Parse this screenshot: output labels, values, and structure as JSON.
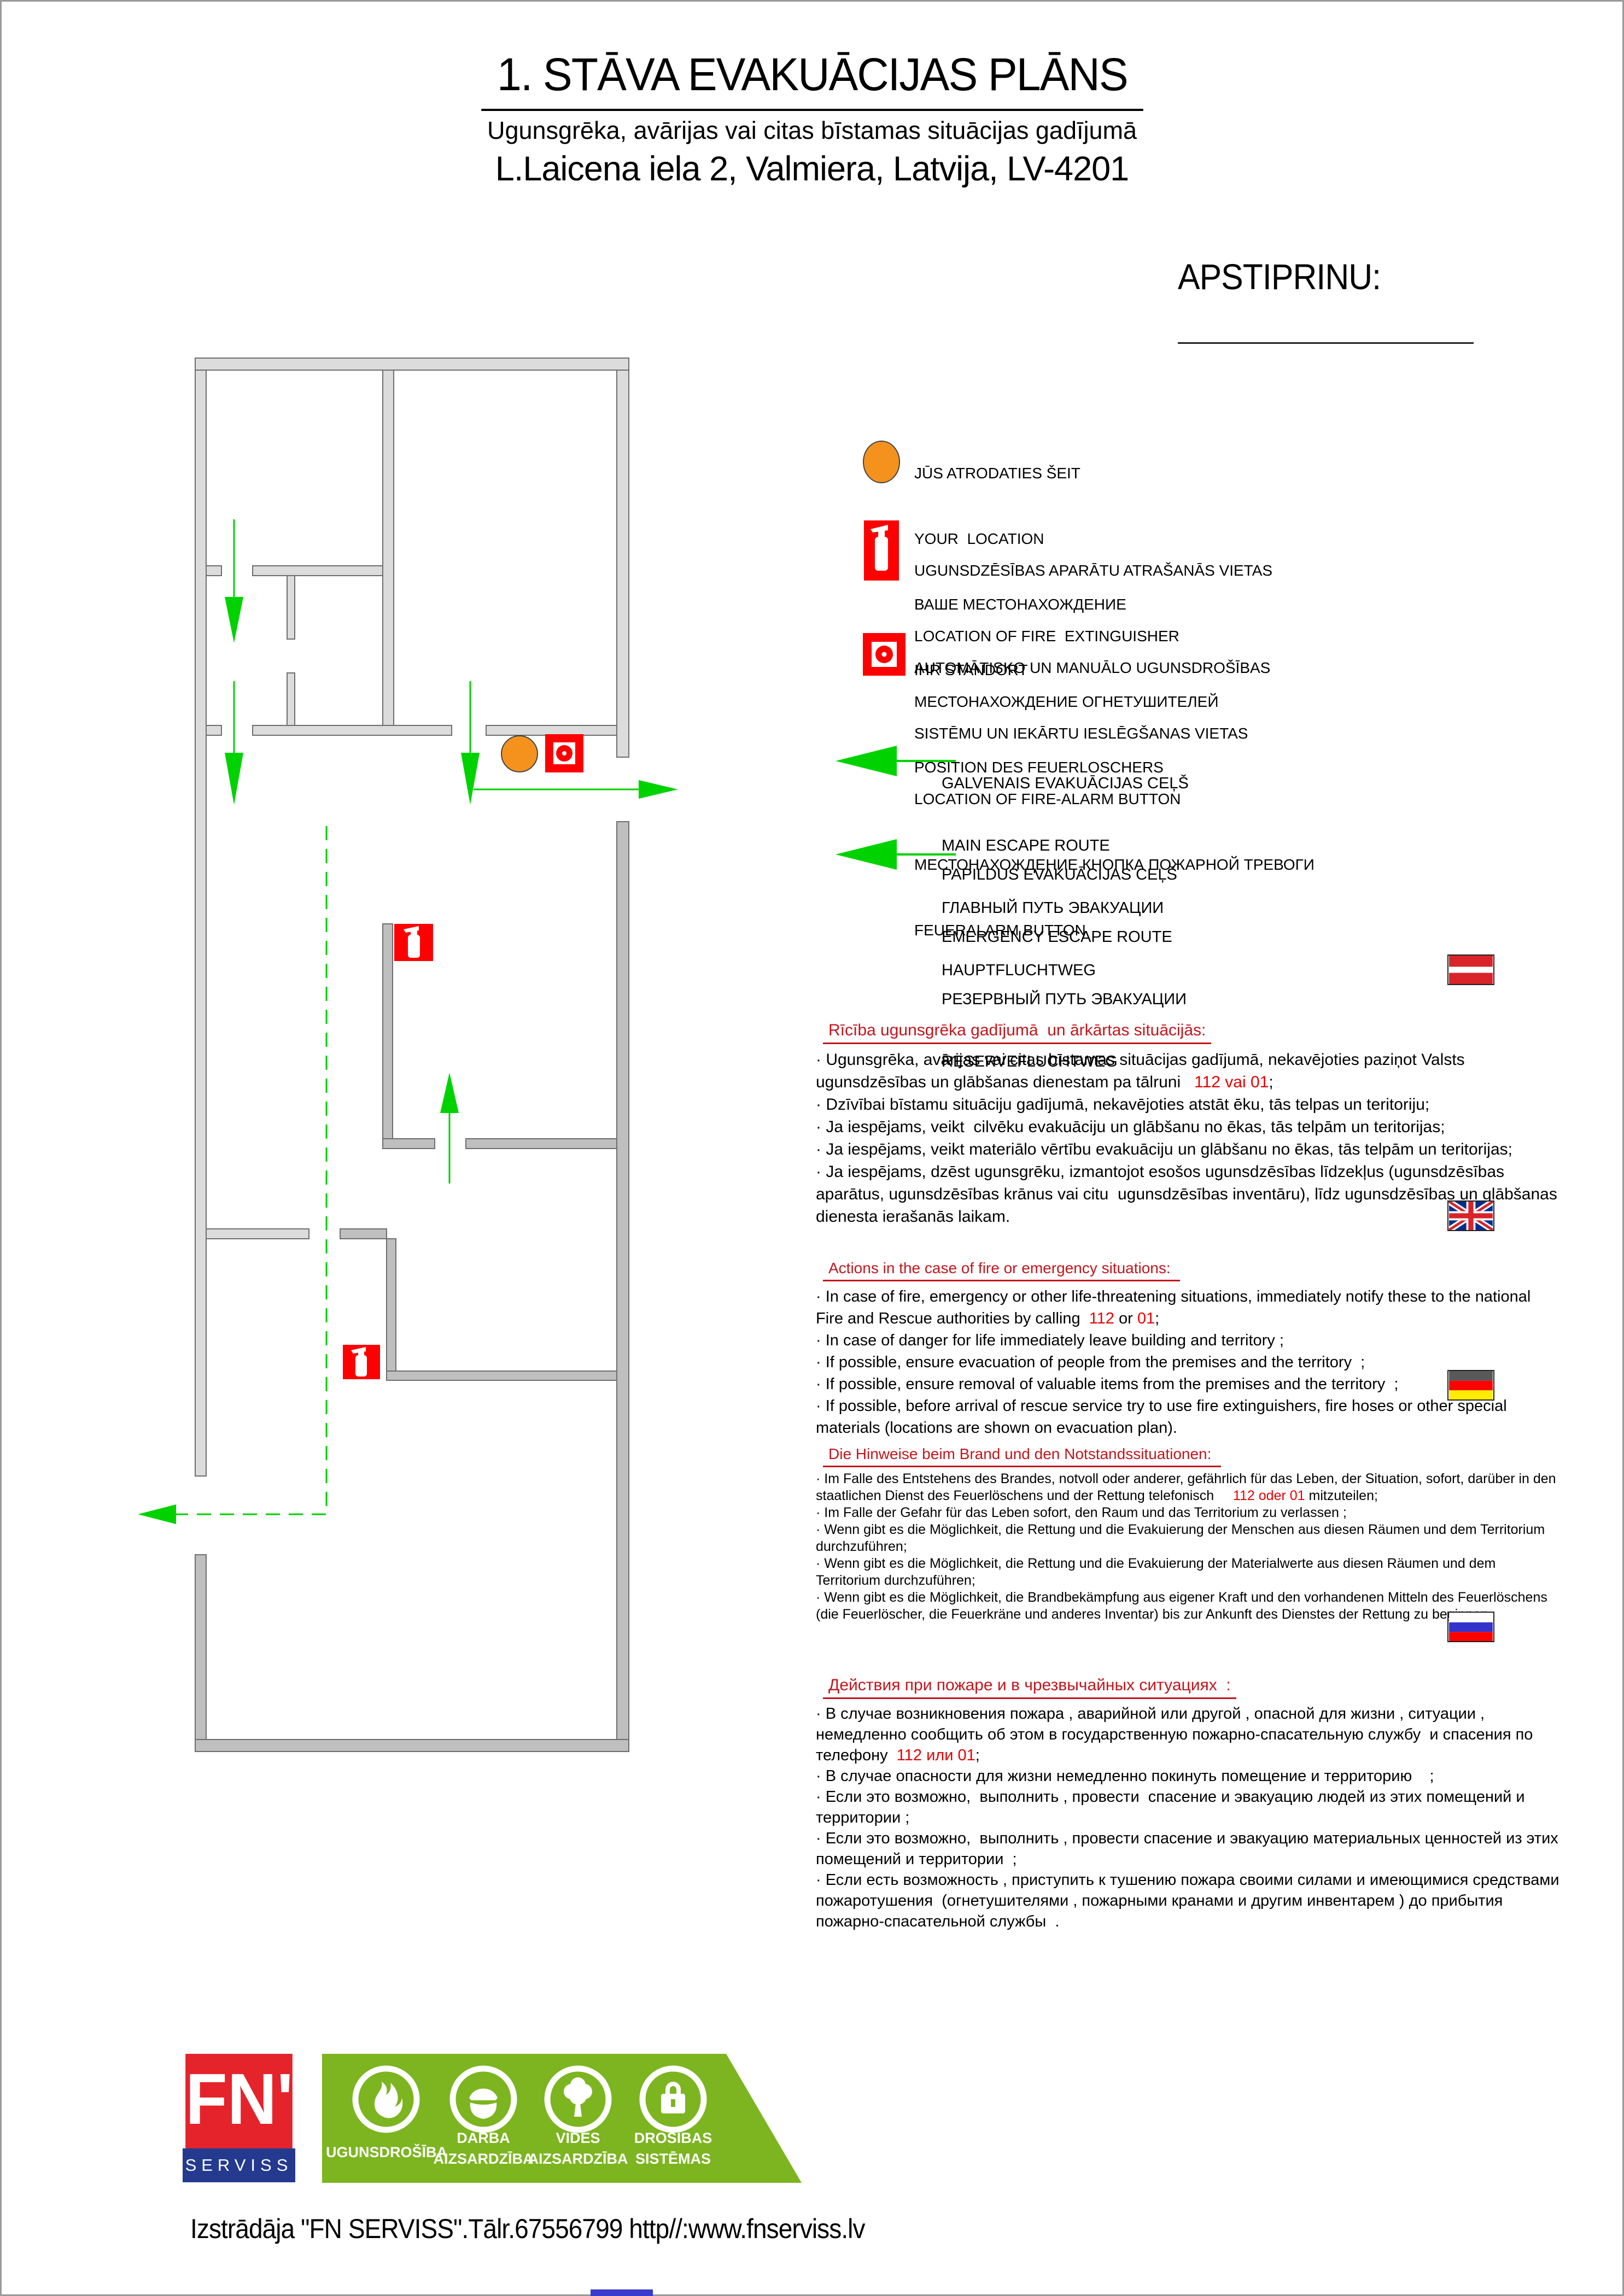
{
  "header": {
    "title": "1. STĀVA EVAKUĀCIJAS PLĀNS",
    "subtitle": "Ugunsgrēka, avārijas vai citas bīstamas situācijas gadījumā",
    "address": "L.Laicena iela 2, Valmiera, Latvija, LV-4201",
    "approve_label": "APSTIPRINU:"
  },
  "colors": {
    "route_green": "#00d200",
    "marker_orange": "#f5921e",
    "symbol_red": "#ff0000",
    "heading_red": "#c3151c",
    "phone_red": "#e60000",
    "wall_light": "#dcdcdc",
    "wall_dark": "#bfbfbf",
    "logo_red": "#e5232b",
    "logo_blue": "#243a8f",
    "logo_green": "#7cb51f"
  },
  "legend": {
    "items": [
      {
        "icon": "your-location-icon",
        "lines": [
          "JŪS ATRODATIES ŠEIT",
          "YOUR  LOCATION",
          "ВАШЕ МЕСТОНАХОЖДЕНИЕ",
          "IHR STANDORT"
        ]
      },
      {
        "icon": "fire-extinguisher-icon",
        "lines": [
          "UGUNSDZĒSĪBAS APARĀTU ATRAŠANĀS VIETAS",
          "LOCATION OF FIRE  EXTINGUISHER",
          "МЕСТОНАХОЖДЕНИЕ ОГНЕТУШИТЕЛЕЙ",
          "POSITION DES FEUERLOSCHERS"
        ]
      },
      {
        "icon": "fire-alarm-button-icon",
        "lines": [
          "AUTOMĀTISKO UN MANUĀLO UGUNSDROŠĪBAS",
          "SISTĒMU UN IEKĀRTU IESLĒGŠANAS VIETAS",
          "LOCATION OF FIRE-ALARM BUTTON",
          "МЕСТОНАХОЖДЕНИЕ КНОПКА ПОЖАРНОЙ ТРЕВОГИ",
          "FEUERALARM BUTTON"
        ]
      },
      {
        "icon": "main-escape-route-arrow-icon",
        "lines": [
          "GALVENAIS EVAKUĀCIJAS CEĻŠ",
          "MAIN ESCAPE ROUTE",
          "ГЛАВНЫЙ ПУТЬ ЭВАКУАЦИИ",
          "HAUPTFLUCHTWEG"
        ]
      },
      {
        "icon": "emergency-escape-route-arrow-icon",
        "lines": [
          "PAPILDUS EVAKUĀCIJAS CEĻŠ",
          "EMERGENCY ESCAPE ROUTE",
          "РЕЗЕРВНЫЙ ПУТЬ ЭВАКУАЦИИ",
          "RESERVEFLUCHTWEG"
        ]
      }
    ]
  },
  "sections": [
    {
      "lang": "lv",
      "flag": "latvia-flag",
      "heading": "Rīcība ugunsgrēka gadījumā  un ārkārtas situācijās:",
      "paragraphs": [
        [
          {
            "t": "· Ugunsgrēka, avārijas vai citas bīstamas situācijas gadījumā, nekavējoties paziņot Valsts ugunsdzēsības un glābšanas dienestam pa tālruni   "
          },
          {
            "t": "112 vai 01",
            "red": true
          },
          {
            "t": ";"
          }
        ],
        [
          {
            "t": "· Dzīvībai bīstamu situāciju gadījumā, nekavējoties atstāt ēku, tās telpas un teritoriju;"
          }
        ],
        [
          {
            "t": "· Ja iespējams, veikt  cilvēku evakuāciju un glābšanu no ēkas, tās telpām un teritorijas;"
          }
        ],
        [
          {
            "t": "· Ja iespējams, veikt materiālo vērtību evakuāciju un glābšanu no ēkas, tās telpām un teritorijas;"
          }
        ],
        [
          {
            "t": "· Ja iespējams, dzēst ugunsgrēku, izmantojot esošos ugunsdzēsības līdzekļus (ugunsdzēsības aparātus, ugunsdzēsības krānus vai citu  ugunsdzēsības inventāru), līdz ugunsdzēsības un glābšanas dienesta ierašanās laikam."
          }
        ]
      ]
    },
    {
      "lang": "en",
      "flag": "united-kingdom-flag",
      "heading": "Actions in the case of fire or emergency situations: ",
      "paragraphs": [
        [
          {
            "t": "· In case of fire, emergency or other life-threatening situations, immediately notify these to the national Fire and Rescue authorities by calling  "
          },
          {
            "t": "112",
            "red": true
          },
          {
            "t": " or "
          },
          {
            "t": "01",
            "red": true
          },
          {
            "t": ";"
          }
        ],
        [
          {
            "t": "· In case of danger for life immediately leave building and territory ;"
          }
        ],
        [
          {
            "t": "· If possible, ensure evacuation of people from the premises and the territory  ;"
          }
        ],
        [
          {
            "t": "· If possible, ensure removal of valuable items from the premises and the territory  ;"
          }
        ],
        [
          {
            "t": "· If possible, before arrival of rescue service try to use fire extinguishers, fire hoses or other special materials (locations are shown on evacuation plan)."
          }
        ]
      ]
    },
    {
      "lang": "de",
      "flag": "germany-flag",
      "heading": "Die Hinweise beim Brand und den Notstandssituationen: ",
      "paragraphs": [
        [
          {
            "t": "· Im Falle des Entstehens des Brandes, notvoll oder anderer, gefährlich für das Leben, der Situation, sofort, darüber in den staatlichen Dienst des Feuerlöschens und der Rettung telefonisch     "
          },
          {
            "t": "112 oder 01",
            "red": true
          },
          {
            "t": " mitzuteilen;"
          }
        ],
        [
          {
            "t": "· Im Falle der Gefahr für das Leben sofort, den Raum und das Territorium zu verlassen ;"
          }
        ],
        [
          {
            "t": "· Wenn gibt es die Möglichkeit, die Rettung und die Evakuierung der Menschen aus diesen Räumen und dem Territorium durchzuführen;"
          }
        ],
        [
          {
            "t": "· Wenn gibt es die Möglichkeit, die Rettung und die Evakuierung der Materialwerte aus diesen Räumen und dem Territorium durchzuführen;"
          }
        ],
        [
          {
            "t": "· Wenn gibt es die Möglichkeit, die Brandbekämpfung aus eigener Kraft und den vorhandenen Mitteln des Feuerlöschens (die Feuerlöscher, die Feuerkräne und anderes Inventar) bis zur Ankunft des Dienstes der Rettung zu beginnen."
          }
        ]
      ]
    },
    {
      "lang": "ru",
      "flag": "russia-flag",
      "heading": "Действия при пожаре и в чрезвычайных ситуациях  :",
      "paragraphs": [
        [
          {
            "t": "· В случае возникновения пожара , аварийной или другой , опасной для жизни , ситуации , немедленно сообщить об этом в государственную пожарно-спасательную службу  и спасения по  телефону  "
          },
          {
            "t": "112 или 01",
            "red": true
          },
          {
            "t": ";"
          }
        ],
        [
          {
            "t": "· В случае опасности для жизни немедленно покинуть помещение и территорию    ;"
          }
        ],
        [
          {
            "t": "· Если это возможно,  выполнить , провести  спасение и эвакуацию людей из этих помещений и территории ;"
          }
        ],
        [
          {
            "t": "· Если это возможно,  выполнить , провести спасение и эвакуацию материальных ценностей из этих помещений и территории  ;"
          }
        ],
        [
          {
            "t": "· Если есть возможность , приступить к тушению пожара своими силами и имеющимися средствами пожаротушения  (огнетушителями , пожарными кранами и другим инвентарем ) до прибытия пожарно-спасательной службы  ."
          }
        ]
      ]
    }
  ],
  "footer": {
    "logo_top": "FN'",
    "logo_bottom": "SERVISS",
    "banner_items": [
      {
        "icon": "flame-icon",
        "label1": "UGUNSDROŠĪBA",
        "label2": ""
      },
      {
        "icon": "helmet-icon",
        "label1": "DARBA",
        "label2": "AIZSARDZĪBA"
      },
      {
        "icon": "tree-icon",
        "label1": "VIDES",
        "label2": "AIZSARDZĪBA"
      },
      {
        "icon": "lock-icon",
        "label1": "DROŠĪBAS",
        "label2": "SISTĒMAS"
      }
    ],
    "developer_line": "Izstrādāja \"FN SERVISS\".Tālr.67556799 http//:www.fnserviss.lv"
  }
}
